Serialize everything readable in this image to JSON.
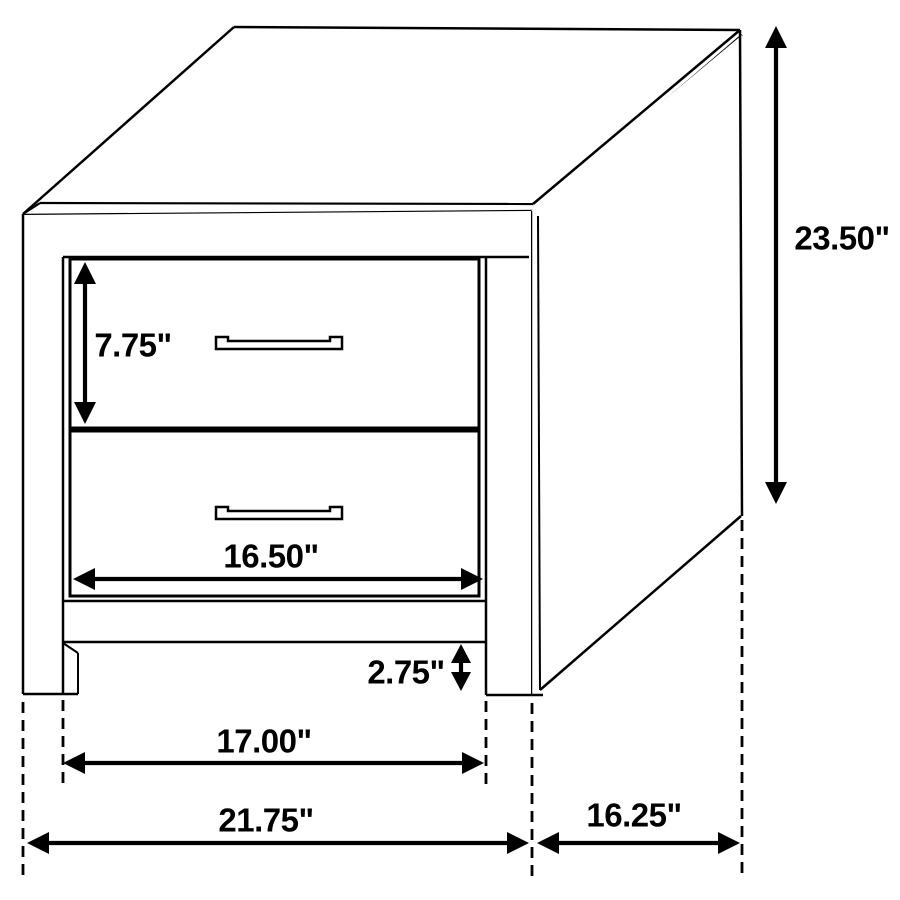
{
  "diagram": {
    "type": "furniture-dimension-drawing",
    "subject": "two-drawer nightstand",
    "labels": {
      "drawer_height": "7.75\"",
      "overall_height": "23.50\"",
      "drawer_width": "16.50\"",
      "leg_clearance": "2.75\"",
      "opening_width": "17.00\"",
      "overall_width": "21.75\"",
      "depth": "16.25\""
    },
    "colors": {
      "line": "#000000",
      "background": "#ffffff",
      "label_text": "#000000"
    }
  }
}
